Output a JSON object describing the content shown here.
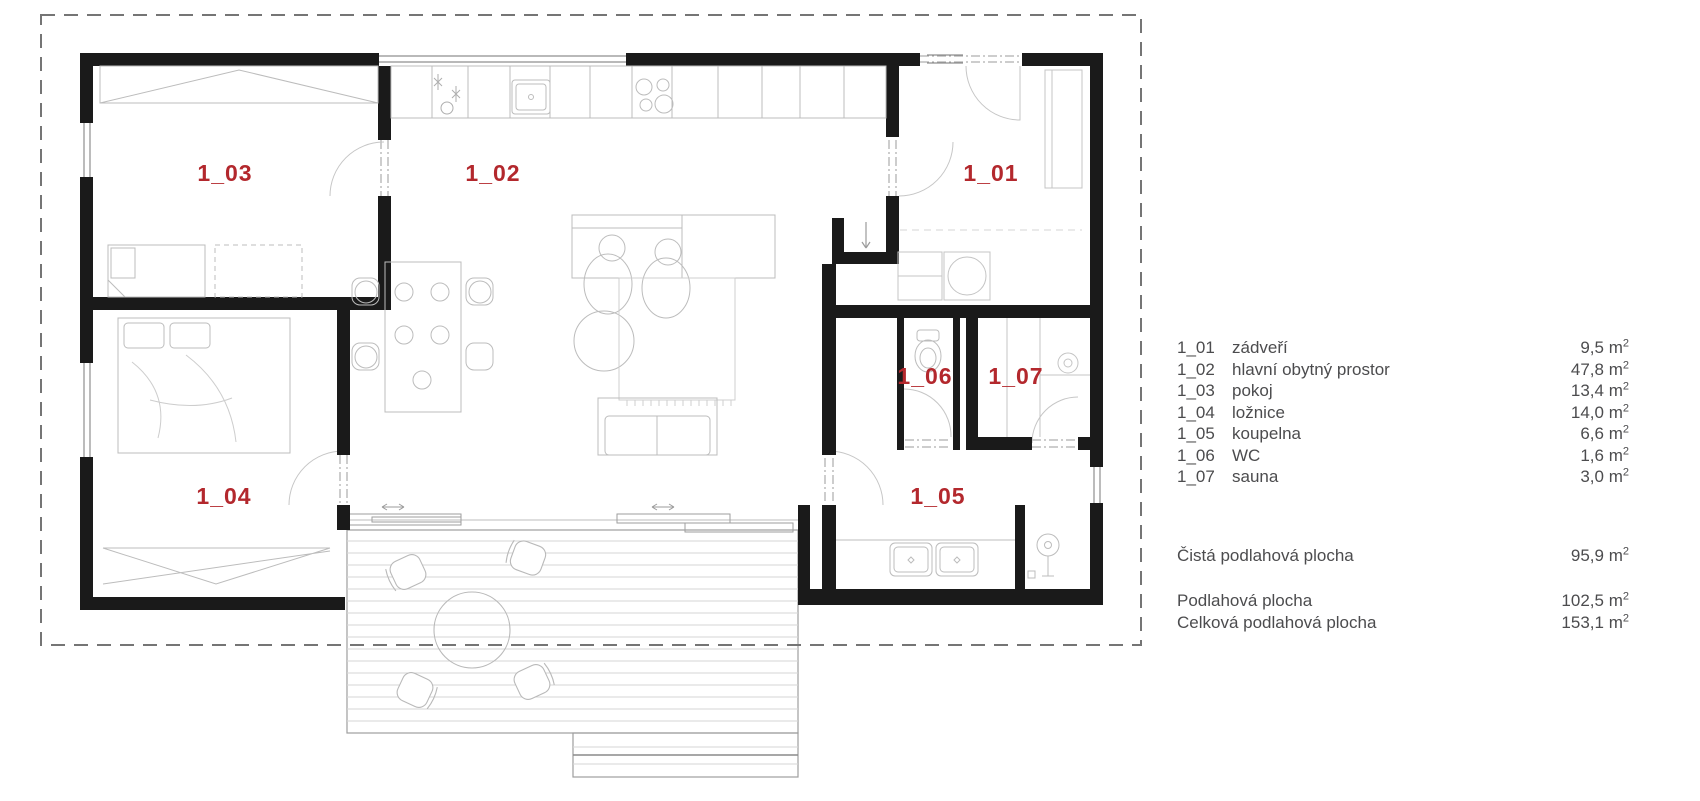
{
  "plan": {
    "rooms": [
      {
        "code": "1_01",
        "name": "zádveří",
        "area": "9,5"
      },
      {
        "code": "1_02",
        "name": "hlavní obytný prostor",
        "area": "47,8"
      },
      {
        "code": "1_03",
        "name": "pokoj",
        "area": "13,4"
      },
      {
        "code": "1_04",
        "name": "ložnice",
        "area": "14,0"
      },
      {
        "code": "1_05",
        "name": "koupelna",
        "area": "6,6"
      },
      {
        "code": "1_06",
        "name": "WC",
        "area": "1,6"
      },
      {
        "code": "1_07",
        "name": "sauna",
        "area": "3,0"
      }
    ],
    "label_color": "#b3282d",
    "wall_color": "#1a1a1a"
  },
  "legend": {
    "unit": "m",
    "unit_sup": "2",
    "totals": [
      {
        "label": "Čistá podlahová plocha",
        "area": "95,9"
      },
      {
        "label": "Podlahová plocha",
        "area": "102,5"
      },
      {
        "label": "Celková podlahová plocha",
        "area": "153,1"
      }
    ]
  }
}
